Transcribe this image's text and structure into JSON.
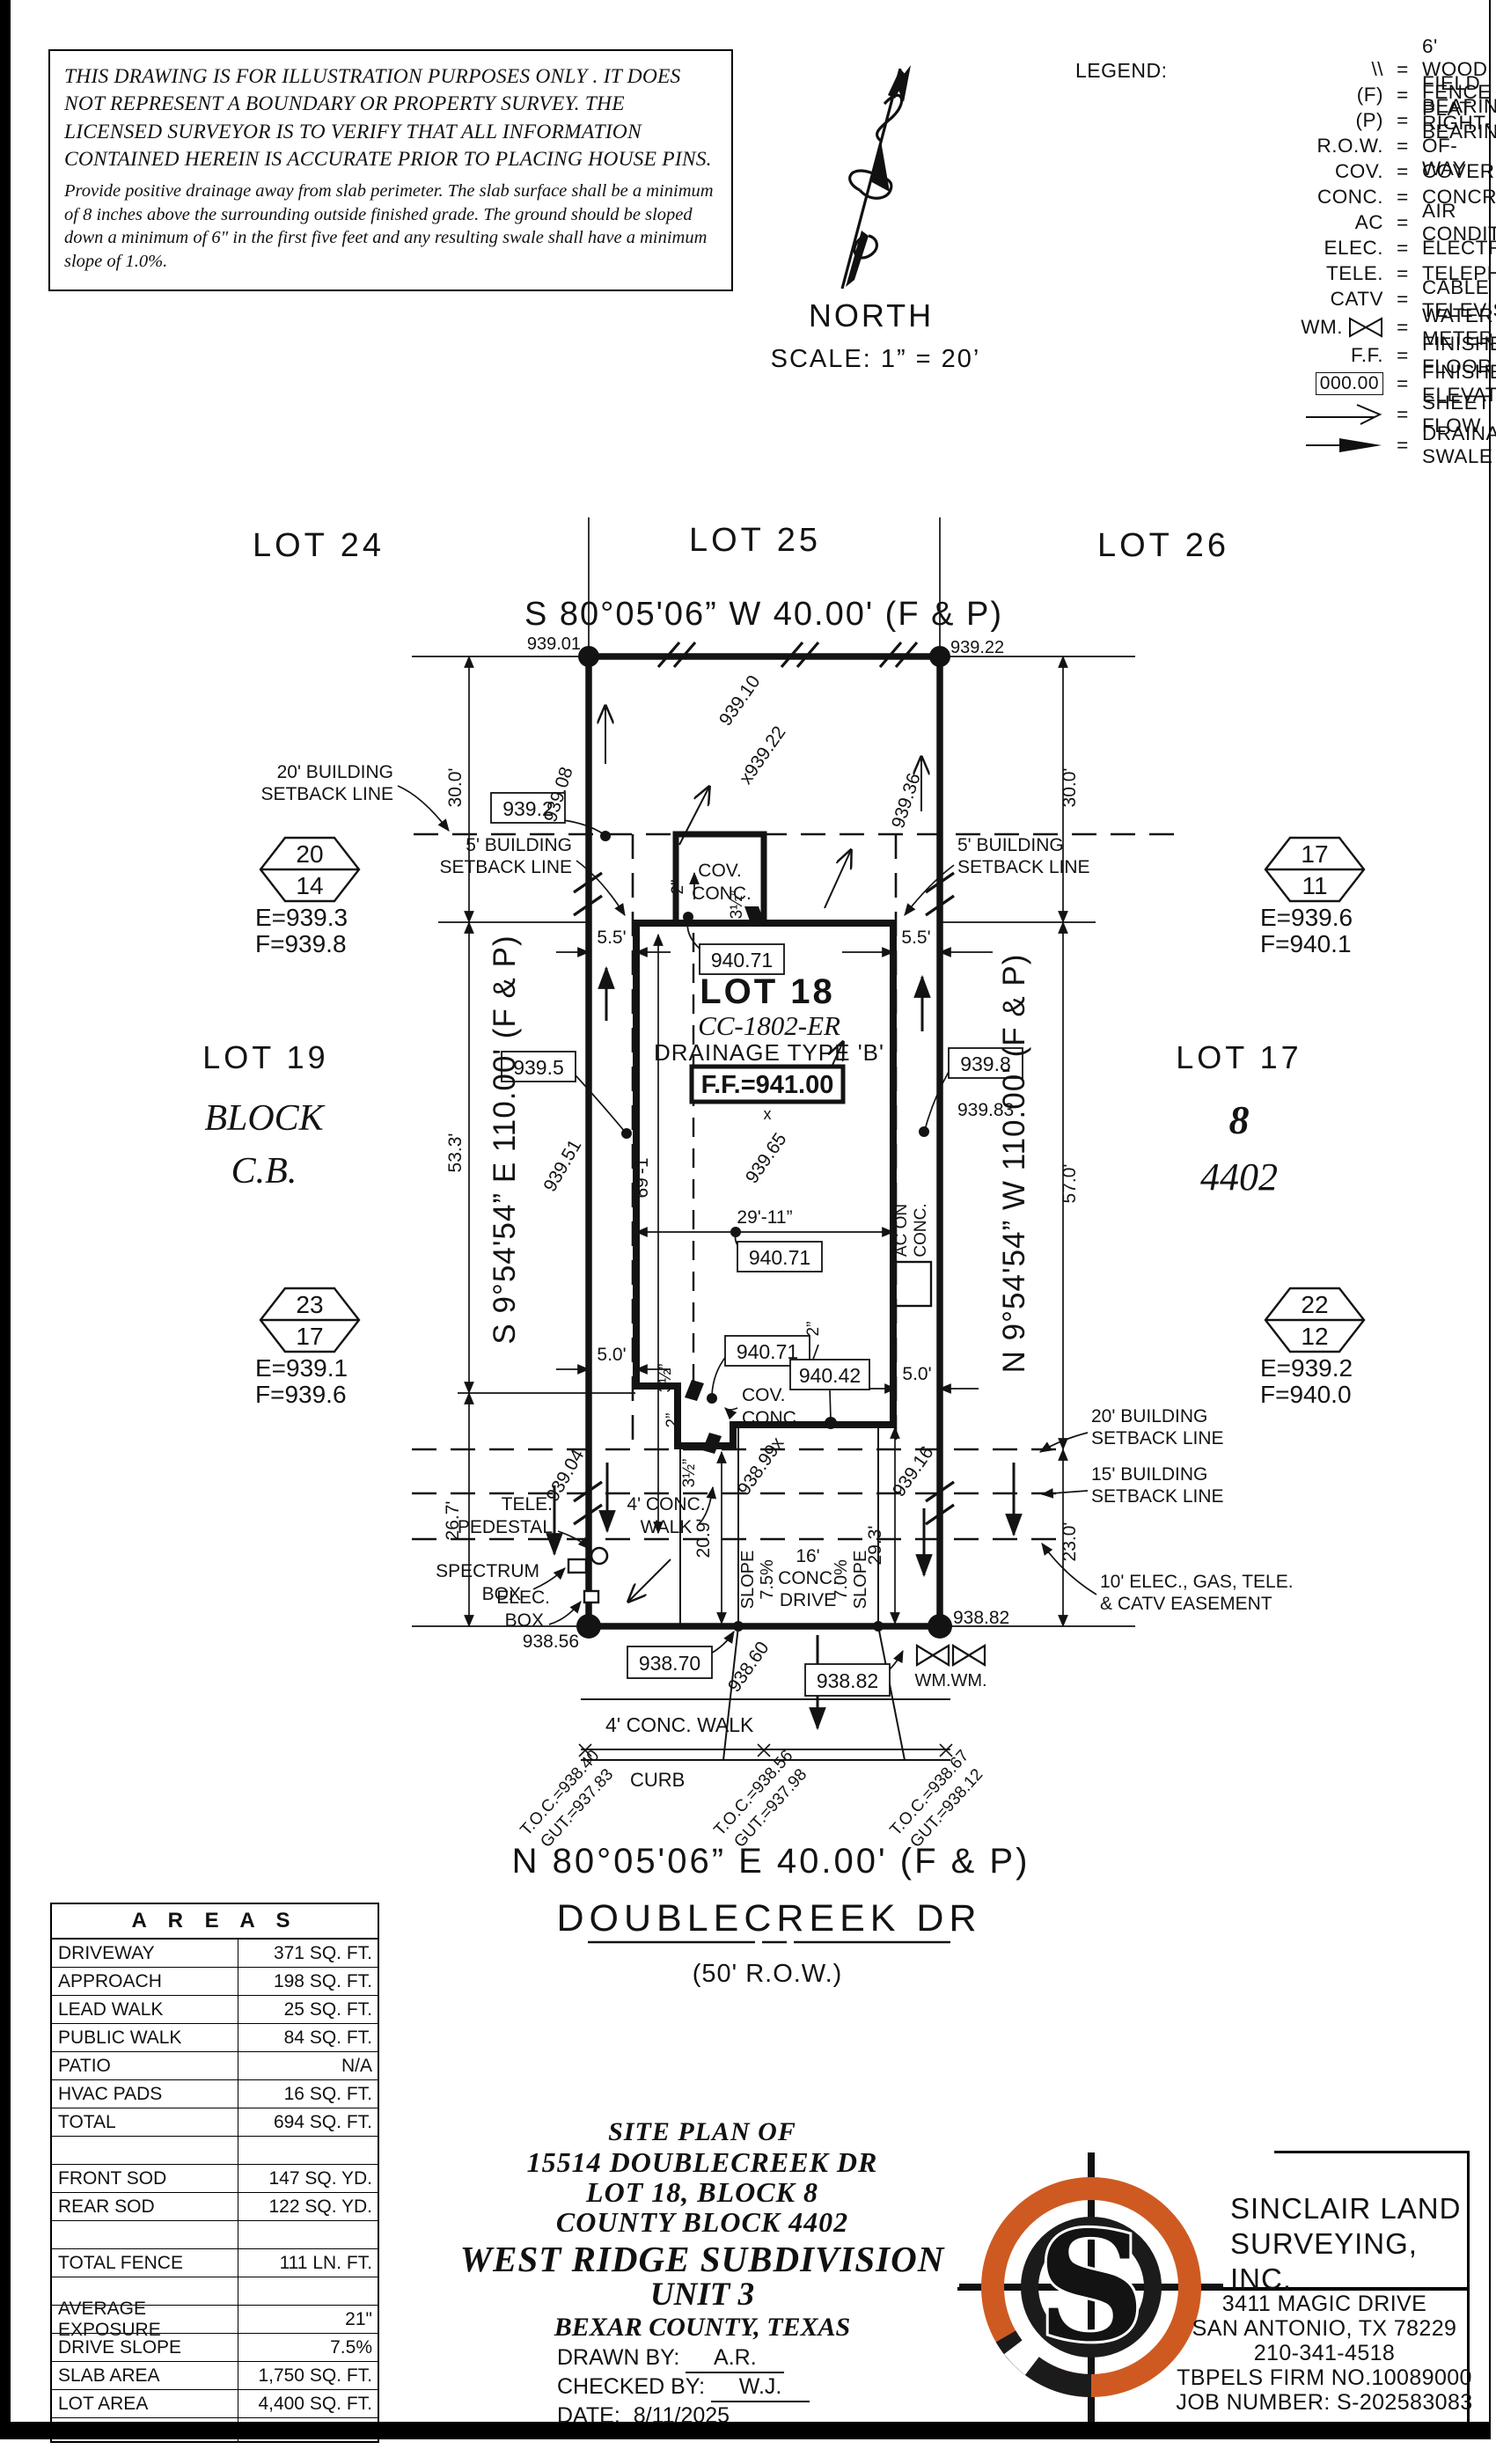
{
  "disclaimer": {
    "big_lines": "THIS DRAWING IS FOR ILLUSTRATION PURPOSES ONLY . IT DOES NOT REPRESENT A BOUNDARY OR PROPERTY SURVEY. THE LICENSED SURVEYOR IS TO VERIFY THAT ALL INFORMATION CONTAINED HEREIN IS ACCURATE PRIOR TO PLACING HOUSE PINS.",
    "small_lines": "Provide positive drainage away from slab perimeter. The slab surface shall be a minimum of 8 inches above the surrounding outside finished grade. The ground should be sloped down a minimum of 6\" in the first five feet and any resulting swale shall have a minimum slope of 1.0%."
  },
  "north": {
    "label": "NORTH",
    "scale": "SCALE:  1”  =  20’"
  },
  "legend": {
    "title": "LEGEND:",
    "items": [
      {
        "sym": "\\\\",
        "label": "6' WOOD FENCE"
      },
      {
        "sym": "(F)",
        "label": "FIELD BEARING"
      },
      {
        "sym": "(P)",
        "label": "PLAT BEARING"
      },
      {
        "sym": "R.O.W.",
        "label": "RIGHT-OF-WAY"
      },
      {
        "sym": "COV.",
        "label": "COVERED"
      },
      {
        "sym": "CONC.",
        "label": "CONCRETE"
      },
      {
        "sym": "AC",
        "label": "AIR CONDITIONER"
      },
      {
        "sym": "ELEC.",
        "label": "ELECTRIC"
      },
      {
        "sym": "TELE.",
        "label": "TELEPHONE"
      },
      {
        "sym": "CATV",
        "label": "CABLE TELEVISION"
      },
      {
        "sym": "WM.",
        "label": "WATER METER"
      },
      {
        "sym": "F.F.",
        "label": "FINISHED FLOOR"
      },
      {
        "sym": "000.00",
        "label": "FINISHED ELEVATION"
      },
      {
        "sym": "",
        "label": "SHEET FLOW"
      },
      {
        "sym": "",
        "label": "DRAINAGE SWALE"
      }
    ]
  },
  "plan": {
    "labels": {
      "lot24": "LOT 24",
      "lot25": "LOT 25",
      "lot26": "LOT 26",
      "bearing_rear": "S 80°05'06” W 40.00' (F & P)",
      "elev_939_01": "939.01",
      "elev_939_22": "939.22",
      "sb20_rear_1": "20' BUILDING",
      "sb20_rear_2": "SETBACK LINE",
      "box_939_2": "939.2",
      "sb5_left_1": "5' BUILDING",
      "sb5_left_2": "SETBACK LINE",
      "sb5_right_1": "5' BUILDING",
      "sb5_right_2": "SETBACK LINE",
      "cov_top_1": "COV.",
      "cov_top_2": "CONC.",
      "dim_30_left": "30.0'",
      "dim_30_right": "30.0'",
      "spot_939_08": "939.08",
      "spot_939_10": "939.10",
      "spot_x939_22": "x939.22",
      "spot_939_36": "939.36",
      "hex1_top": "20",
      "hex1_bot": "14",
      "hex1_e": "E=939.3",
      "hex1_f": "F=939.8",
      "hex2_top": "17",
      "hex2_bot": "11",
      "hex2_e": "E=939.6",
      "hex2_f": "F=940.1",
      "hex3_top": "23",
      "hex3_bot": "17",
      "hex3_e": "E=939.1",
      "hex3_f": "F=939.6",
      "hex4_top": "22",
      "hex4_bot": "12",
      "hex4_e": "E=939.2",
      "hex4_f": "F=940.0",
      "lot19": "LOT 19",
      "block_w": "BLOCK",
      "cb": "C.B.",
      "lot17": "LOT 17",
      "blk8": "8",
      "cb4402": "4402",
      "bearing_left": "S 9°54'54” E 110.00' (F & P)",
      "bearing_right": "N 9°54'54” W 110.00' (F & P)",
      "dim_55_l": "5.5'",
      "dim_55_r": "5.5'",
      "box_940_71a": "940.71",
      "box_940_71b": "940.71",
      "box_940_71c": "940.71",
      "box_940_42": "940.42",
      "lot18": "LOT 18",
      "cc": "CC-1802-ER",
      "drainage": "DRAINAGE TYPE 'B'",
      "ff": "F.F.=941.00",
      "spot_939_65": "939.65",
      "spot_939_51": "939.51",
      "box_939_5": "939.5",
      "box_939_8": "939.8",
      "spot_939_83": "939.83",
      "dim_69_1": "69'-1”",
      "dim_29_11": "29'-11”",
      "dim_53_3": "53.3'",
      "dim_57_0": "57.0'",
      "dim_2a": "2”",
      "dim_35a": "3½”",
      "dim_2b": "2”",
      "dim_2c": "2”",
      "dim_35b": "3½”",
      "dim_35c": "3½”",
      "dim_5_l": "5.0'",
      "dim_5_r": "5.0'",
      "cov_bot_1": "COV.",
      "cov_bot_2": "CONC.",
      "ac_1": "AC ON",
      "ac_2": "CONC.",
      "spot_939_04": "939.04",
      "spot_938_99": "938.99x",
      "spot_939_16": "939.16",
      "tele_1": "TELE.",
      "tele_2": "PEDESTAL",
      "spectrum_1": "SPECTRUM",
      "spectrum_2": "BOX",
      "elecbox_1": "ELEC.",
      "elecbox_2": "BOX",
      "dim_26_7": "26.7'",
      "dim_20_9": "20.9'",
      "dim_29_3": "29.3'",
      "dim_23_0": "23.0'",
      "walk_1": "4' CONC.",
      "walk_2": "WALK",
      "slope_a1": "SLOPE",
      "slope_a2": "7.5%",
      "drive_1": "16'",
      "drive_2": "CONC.",
      "drive_3": "DRIVE",
      "slope_b1": "7.0%",
      "slope_b2": "SLOPE",
      "sb20_front_1": "20' BUILDING",
      "sb20_front_2": "SETBACK LINE",
      "sb15_1": "15' BUILDING",
      "sb15_2": "SETBACK LINE",
      "esmt_1": "10' ELEC., GAS, TELE.",
      "esmt_2": "& CATV EASEMENT",
      "elev_938_56": "938.56",
      "box_938_70": "938.70",
      "spot_938_60": "938.60",
      "box_938_82": "938.82",
      "elev_938_82": "938.82",
      "wm1": "WM.",
      "wm2": "WM.",
      "pubwalk": "4' CONC. WALK",
      "curb": "CURB",
      "toc1a": "T.O.C.=938.40",
      "toc1b": "GUT.=937.83",
      "toc2a": "T.O.C.=938.56",
      "toc2b": "GUT.=937.98",
      "toc3a": "T.O.C.=938.67",
      "toc3b": "GUT.=938.12",
      "bearing_front": "N 80°05'06” E 40.00' (F & P)",
      "street": "DOUBLECREEK DR",
      "row50": "(50' R.O.W.)"
    }
  },
  "areas": {
    "title": "A R E A S",
    "rows": [
      {
        "label": "DRIVEWAY",
        "value": "371 SQ. FT."
      },
      {
        "label": "APPROACH",
        "value": "198 SQ. FT."
      },
      {
        "label": "LEAD WALK",
        "value": "25 SQ. FT."
      },
      {
        "label": "PUBLIC WALK",
        "value": "84 SQ. FT."
      },
      {
        "label": "PATIO",
        "value": "N/A"
      },
      {
        "label": "HVAC PADS",
        "value": "16 SQ. FT."
      },
      {
        "label": "TOTAL",
        "value": "694 SQ. FT."
      },
      {
        "label": "",
        "value": ""
      },
      {
        "label": "FRONT SOD",
        "value": "147 SQ. YD."
      },
      {
        "label": "REAR SOD",
        "value": "122 SQ. YD."
      },
      {
        "label": "",
        "value": ""
      },
      {
        "label": "TOTAL FENCE",
        "value": "111 LN. FT."
      },
      {
        "label": "",
        "value": ""
      },
      {
        "label": "AVERAGE EXPOSURE",
        "value": "21\""
      },
      {
        "label": "DRIVE SLOPE",
        "value": "7.5%"
      },
      {
        "label": "SLAB AREA",
        "value": "1,750 SQ. FT."
      },
      {
        "label": "LOT AREA",
        "value": "4,400 SQ. FT."
      },
      {
        "label": "",
        "value": ""
      }
    ]
  },
  "title_block": {
    "l1": "SITE PLAN OF",
    "l2": "15514 DOUBLECREEK DR",
    "l3": "LOT 18, BLOCK 8",
    "l4": "COUNTY BLOCK 4402",
    "l5": "WEST RIDGE SUBDIVISION",
    "l6": "UNIT 3",
    "l7": "BEXAR COUNTY, TEXAS",
    "fields": [
      {
        "label": "DRAWN BY:",
        "value": "A.R."
      },
      {
        "label": "CHECKED BY:",
        "value": "W.J."
      },
      {
        "label": "DATE:",
        "value": "8/11/2025"
      }
    ]
  },
  "firm": {
    "name1": "SINCLAIR LAND",
    "name2": "SURVEYING, INC.",
    "address1": "3411 MAGIC DRIVE",
    "address2": "SAN ANTONIO, TX 78229",
    "phone": "210-341-4518",
    "firm_no": "TBPELS FIRM NO.10089000",
    "job": "JOB NUMBER: S-202583083",
    "logo_letter": "S",
    "orange": "#CE5A22"
  }
}
